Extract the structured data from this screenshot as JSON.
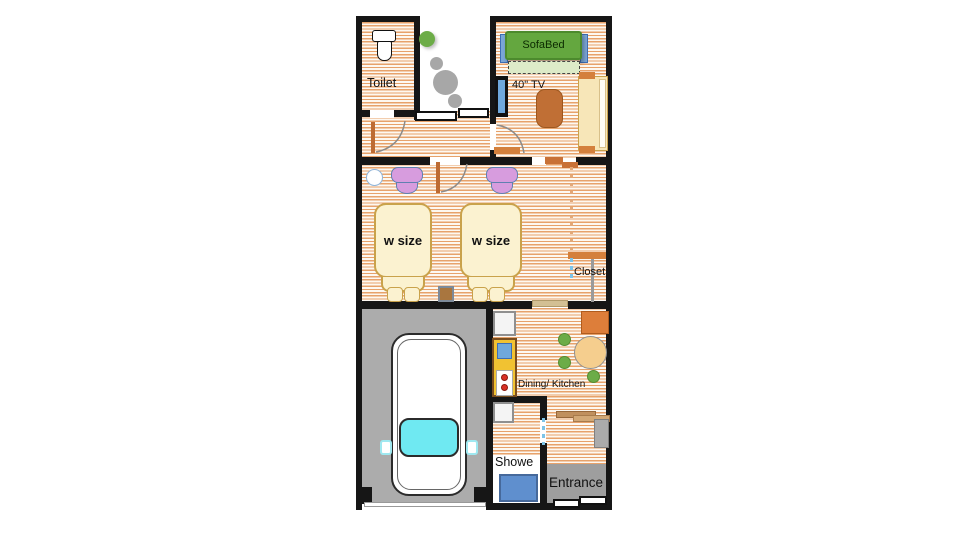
{
  "labels": {
    "toilet": "Toilet",
    "sofabed": "SofaBed",
    "tv": "40\" TV",
    "bed1": "w size",
    "bed2": "w size",
    "closet": "Closet",
    "dining_kitchen": "Dining/ Kitchen",
    "shower": "Showe",
    "entrance": "Entrance"
  },
  "palette": {
    "wall": "#161616",
    "floor_stripe": "#E7A26B",
    "floor_bg": "#FDF8F1",
    "garage_floor": "#ACACAC",
    "entrance_floor": "#9E9E9E",
    "sofa_green": "#64A73F",
    "sofa_extension_green": "#DDEBC8",
    "armrest_blue": "#7BA7D7",
    "tv_screen_blue": "#6FA8DC",
    "coffee_table_brown": "#C06F35",
    "bench_cream": "#F7E6B8",
    "accent_orange": "#D4803C",
    "door_leaf_brown": "#BD6B33",
    "chair_purple": "#D79CDE",
    "bed_cream": "#FBF2D0",
    "bed_border": "#C9A24B",
    "plant_green": "#6CAC47",
    "stone_gray": "#A7A7A7",
    "counter_yellow": "#F1C232",
    "sink_blue": "#6FA8DC",
    "burner_red": "#D93025",
    "dining_table_tan": "#F5CE8E",
    "dining_chair_green": "#6CAC47",
    "cabinet_orange": "#DD7E3A",
    "shower_tray_blue": "#5F8FCE",
    "car_body": "#FFFFFF",
    "car_windshield_cyan": "#6FE9F2",
    "door_dash_blue": "#7CC4E8"
  }
}
